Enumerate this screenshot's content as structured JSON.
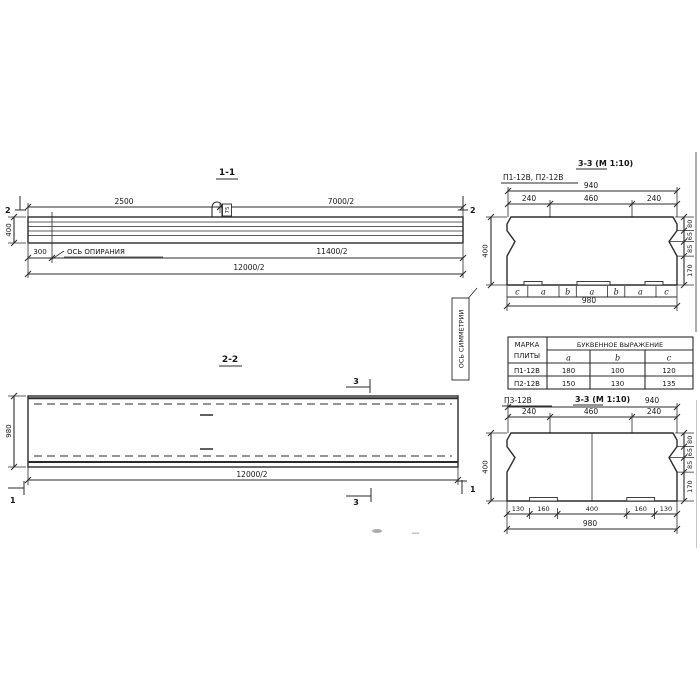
{
  "colors": {
    "ink": "#2b2b2b",
    "paper": "#ffffff"
  },
  "view11": {
    "title": "1-1",
    "mark_left": "2",
    "mark_right": "2",
    "dim_2500": "2500",
    "dim_7000": "7000/2",
    "dim_400": "400",
    "dim_300": "300",
    "dim_11400": "11400/2",
    "dim_12000": "12000/2",
    "support_axis_label": "ОСЬ ОПИРАНИЯ",
    "loop_label": "75"
  },
  "view22": {
    "title": "2-2",
    "mark_top": "3",
    "mark_bottom": "3",
    "mark_left": "1",
    "mark_right": "1",
    "dim_980": "980",
    "dim_12000": "12000/2",
    "symmetry_axis_label": "ОСЬ СИММЕТРИИ"
  },
  "sec_top": {
    "title": "3-3 (М 1:10)",
    "marks": "П1-12В, П2-12В",
    "dim_940": "940",
    "dim_240_left": "240",
    "dim_460": "460",
    "dim_240_right": "240",
    "dim_400": "400",
    "dim_980": "980",
    "right_dims": [
      "80",
      "65",
      "85",
      "170"
    ],
    "letters": [
      "c",
      "a",
      "b",
      "a",
      "b",
      "a",
      "c"
    ]
  },
  "table": {
    "header_mark_lines": [
      "МАРКА",
      "ПЛИТЫ"
    ],
    "header_expr": "БУКВЕННОЕ ВЫРАЖЕНИЕ",
    "columns": [
      "a",
      "b",
      "c"
    ],
    "rows": [
      [
        "П1-12В",
        "180",
        "100",
        "120"
      ],
      [
        "П2-12В",
        "150",
        "130",
        "135"
      ]
    ]
  },
  "sec_bottom": {
    "mark": "П3-12В",
    "title": "3-3 (М 1:10)",
    "dim_940": "940",
    "dim_240_left": "240",
    "dim_460": "460",
    "dim_240_right": "240",
    "dim_400": "400",
    "dim_980": "980",
    "right_dims": [
      "80",
      "65",
      "85",
      "170"
    ],
    "bottom_dims": [
      "130",
      "160",
      "400",
      "160",
      "130"
    ]
  }
}
